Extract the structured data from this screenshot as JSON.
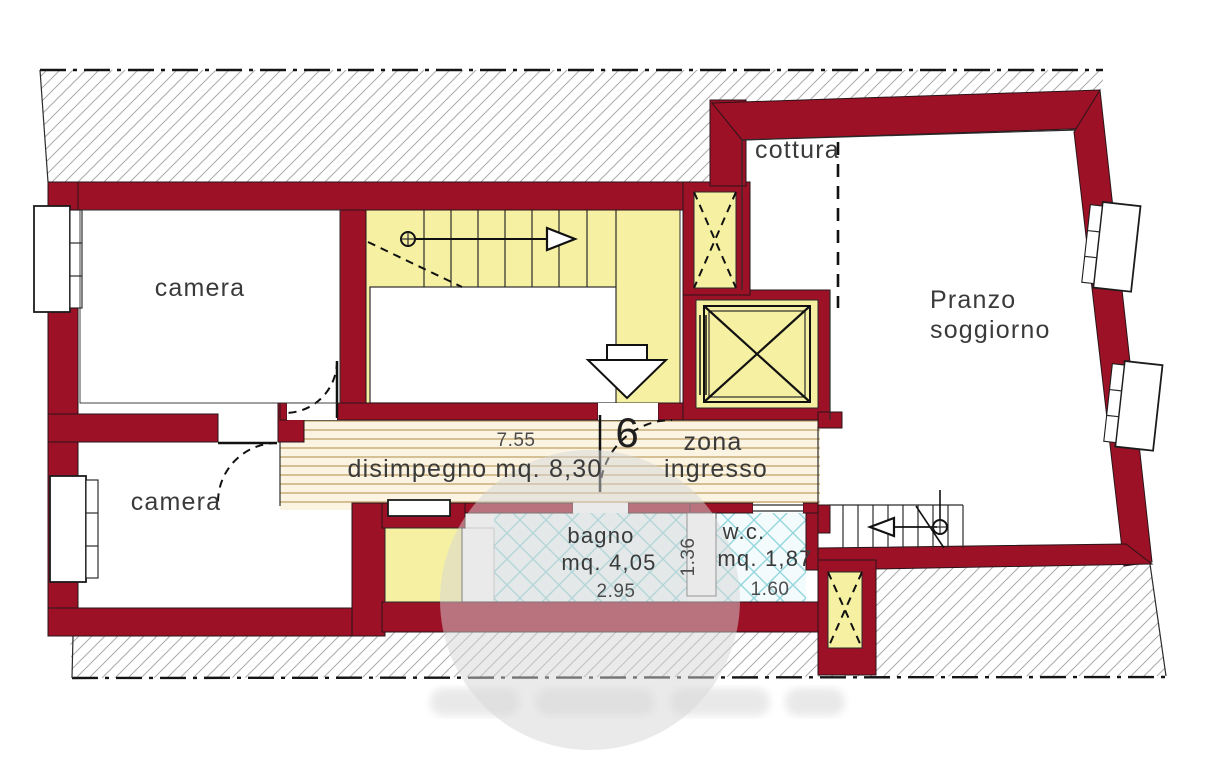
{
  "plan": {
    "unit_number": "6",
    "labels": {
      "camera1": "camera",
      "camera2": "camera",
      "cottura": "cottura",
      "pranzo_line1": "Pranzo",
      "pranzo_line2": "soggiorno",
      "disimpegno": "disimpegno mq. 8,30",
      "zona_line1": "zona",
      "zona_line2": "ingresso",
      "bagno_line1": "bagno",
      "bagno_line2": "mq. 4,05",
      "wc_line1": "w.c.",
      "wc_line2": "mq. 1,87"
    },
    "dimensions": {
      "corridor_length": "7.55",
      "bagno_width": "2.95",
      "bagno_wc_depth": "1.36",
      "wc_width": "1.60"
    },
    "colors": {
      "wall": "#9c1126",
      "stairFill": "#f6f1a2",
      "stripeBg": "#fbf4e2",
      "stripeLine": "#d6bf92",
      "tileBg": "#f3fbfc",
      "tileLine": "#93d6dd",
      "hatchLine": "#ababab",
      "label": "#3a3a3a",
      "dim": "#4d4d4d",
      "watermark": "#d6d6d6"
    }
  }
}
